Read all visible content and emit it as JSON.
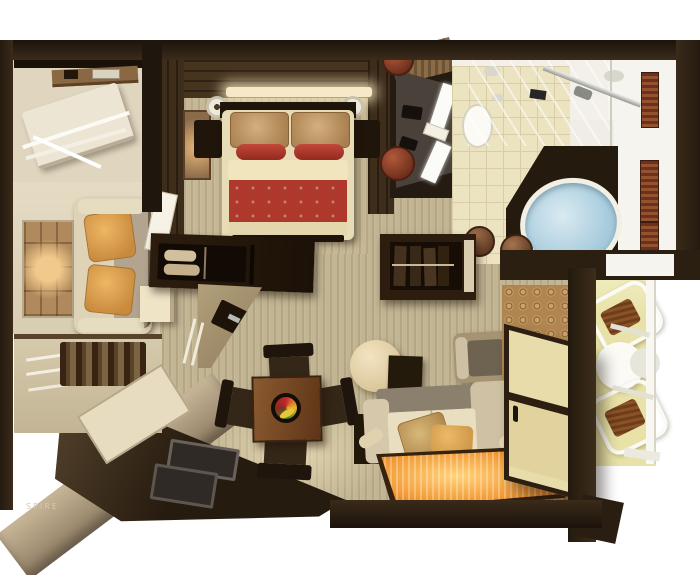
{
  "watermark": "SPIRE",
  "scene": {
    "type": "3d_rendered_floor_plan_top_view",
    "rooms": [
      "closet",
      "bedroom",
      "vanity-dressing-area",
      "bathroom",
      "living-area",
      "minibar-nook",
      "dining-area",
      "lounge-area",
      "entry-hall",
      "balcony"
    ],
    "furniture": {
      "closet": [
        "wall-shelf",
        "folding-luggage-rack"
      ],
      "bedroom": [
        "double-bed",
        "tan-pillows",
        "red-accent-pillows",
        "red-bed-runner",
        "nightstands",
        "wall-sconce-lamps",
        "wall-artwork",
        "open-door"
      ],
      "vanity-dressing-area": [
        "wood-shelf",
        "counter-with-mirrors",
        "round-leather-stools",
        "telephones"
      ],
      "bathroom": [
        "glass-shower",
        "shower-bar",
        "toilet",
        "oval-bathtub",
        "vessel-bowls",
        "slatted-towel-racks",
        "wall-sconces"
      ],
      "living-area": [
        "stone-artwork",
        "two-seat-sofa",
        "orange-pillows",
        "cube-side-table",
        "minibar-shelves",
        "bottle-rack"
      ],
      "dining-area": [
        "square-wood-table",
        "fruit-platter",
        "four-dark-chairs",
        "media-cabinet",
        "rolled-towel-shelf",
        "angled-console-desk",
        "recessed-floor-trays"
      ],
      "lounge-area": [
        "wardrobe-with-clothes",
        "round-pouf",
        "dark-side-cabinet",
        "armchair",
        "sofa-with-cushions",
        "bolster-pillows",
        "striped-orange-rug",
        "dark-wood-floor"
      ],
      "entry-hall": [
        "ring-pattern-runner",
        "shoji-sliding-door"
      ],
      "balcony": [
        "two-slatted-loungers",
        "round-white-table",
        "white-railing"
      ]
    }
  },
  "colors": {
    "background": "#ffffff",
    "wall_dark_wood": "#2b1f12",
    "bedroom_wall_wood": "#47341f",
    "carpet_beige": "#c4b795",
    "wall_cream": "#e5dbc4",
    "bed_linen_cream": "#e8dcb6",
    "bed_runner_red": "#ae382c",
    "pillow_orange": "#d89a4e",
    "rug_orange": "#f09a38",
    "bathtub_blue": "#a6cbdc",
    "bathroom_tile": "#ece3c1",
    "towel_rack_red": "#7e3a20",
    "balcony_floor": "#e8e2a8",
    "shoji_panel": "#e9dcab",
    "entry_rug_tan": "#b08550"
  }
}
